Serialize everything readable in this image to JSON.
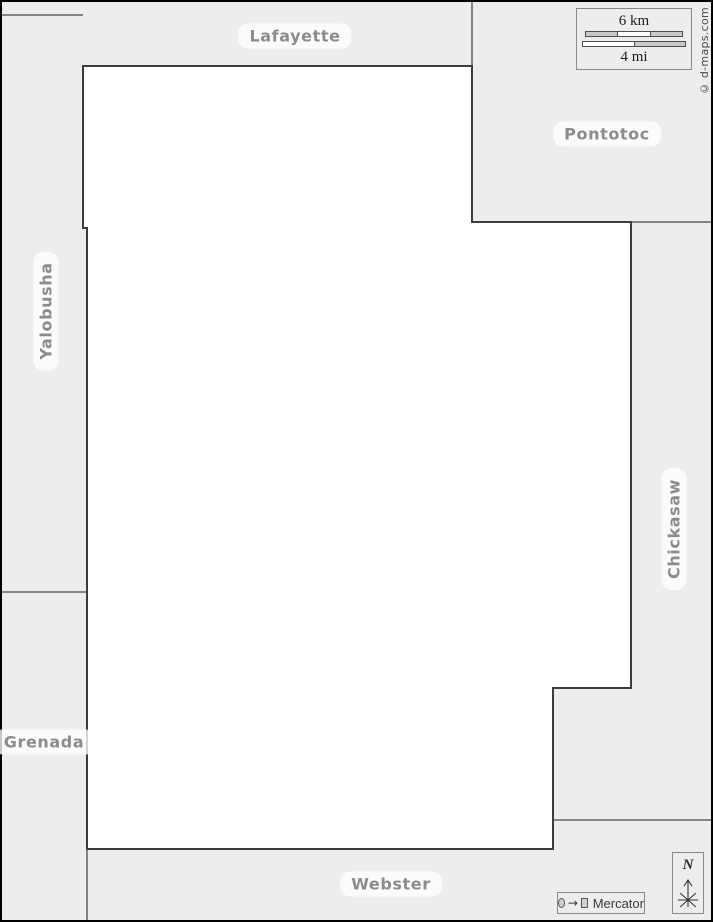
{
  "map": {
    "neighbors": {
      "lafayette": "Lafayette",
      "pontotoc": "Pontotoc",
      "yalobusha": "Yalobusha",
      "chickasaw": "Chickasaw",
      "grenada": "Grenada",
      "webster": "Webster"
    }
  },
  "scale_bar": {
    "km_label": "6 km",
    "mi_label": "4 mi"
  },
  "compass": {
    "north_label": "N"
  },
  "projection_badge": {
    "label": "Mercator",
    "arrow_glyph": "→"
  },
  "copyright": {
    "text": "© d-maps.com"
  },
  "colors": {
    "background": "#ededed",
    "county_fill": "#ffffff",
    "county_border": "#3c3c3c",
    "neighbor_border": "#4a4a4a",
    "frame": "#000000",
    "label_text": "#8c8c8c",
    "scale_segment_silver": "#c9c9c9"
  }
}
